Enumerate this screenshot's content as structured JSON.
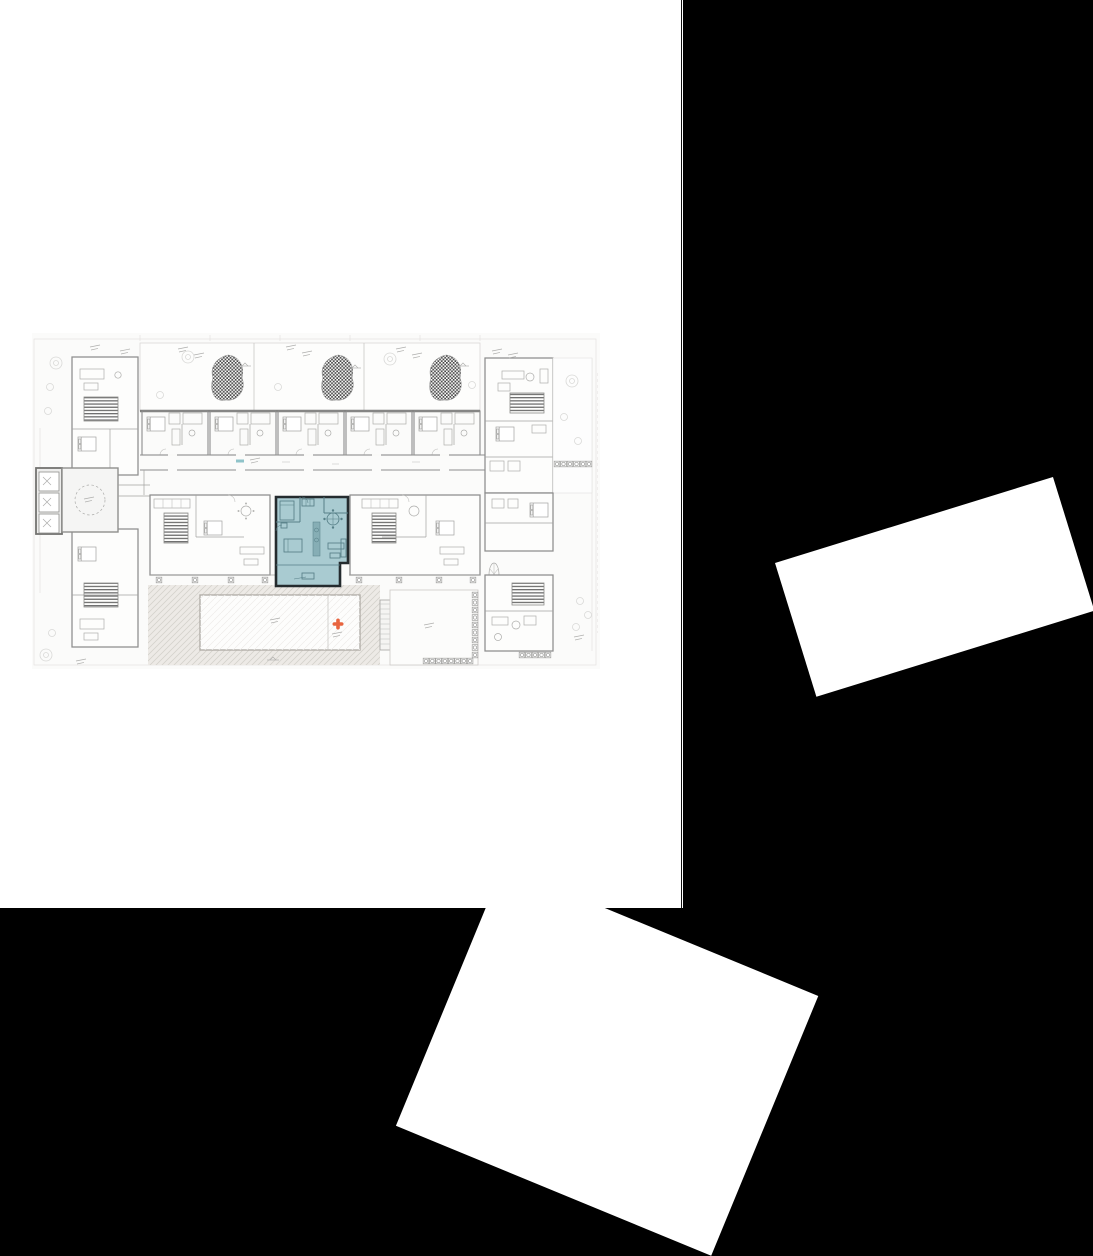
{
  "window": {
    "width": 1093,
    "height": 1256
  },
  "page": {
    "width": 682,
    "height": 908
  },
  "floor_plan": {
    "kind": "architectural-floor-plan",
    "elements": {
      "highlighted_unit": "teal highlighted apartment unit with furniture and terrace",
      "pool": "rectangular pool on hatched deck terrace",
      "pool_marker": "orange plus-shaped marker",
      "elevator_core": "elevator shafts with dashed-circle courtyard",
      "stairs": "hatched stair blocks",
      "planting_beds": "dark speckled organic planting blobs on upper terraces",
      "corridor_marker": "small teal corridor tag"
    }
  },
  "overlays": {
    "right_card": {
      "rotation_deg": -17.2
    },
    "bottom_card": {
      "rotation_deg": 22.4
    }
  },
  "colors": {
    "canvas_bg": "#000000",
    "page_bg": "#ffffff",
    "page_edge_dark": "#101010",
    "overlay_card": "#ffffff",
    "plan_fill": "#fbfbfa",
    "plan_fill_room": "#fdfdfc",
    "plan_wall": "#8d8d8d",
    "plan_line_light": "#c9c7c4",
    "plan_line_faint": "#e4e2e0",
    "deck_fill": "#edeae6",
    "deck_line": "#d5d2cc",
    "stair_hatch": "#6f6f6f",
    "planting_dot": "#474747",
    "highlight_fill": "#a9cbd1",
    "highlight_outline": "#242b2e",
    "highlight_furniture": "#567f87",
    "highlight_counter": "#86aeb5",
    "marker_orange": "#e8643f",
    "corridor_marker": "#8fc3c9"
  }
}
